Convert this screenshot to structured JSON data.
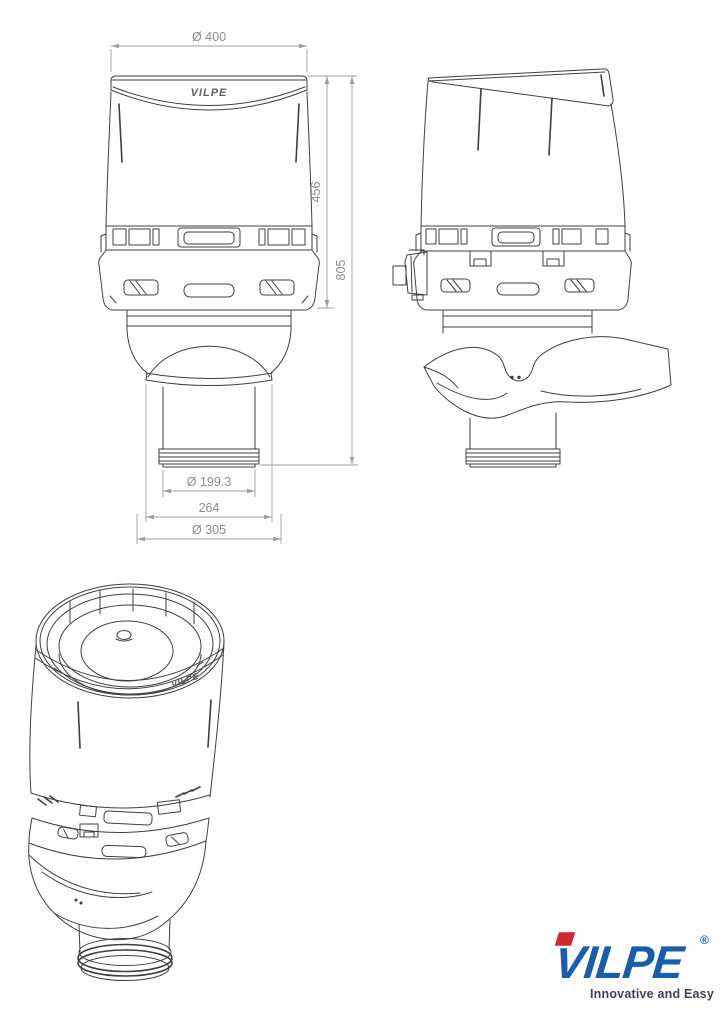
{
  "page": {
    "background": "#ffffff"
  },
  "drawing": {
    "front_view": {
      "dimensions": {
        "top_diameter": "Ø 400",
        "cap_height": "456",
        "total_height": "805",
        "pipe_diameter": "Ø 199.3",
        "outlet_width": "264",
        "insulation_diameter": "Ø 305"
      },
      "embossed_logo": "VILPE"
    },
    "isometric_view": {
      "embossed_logo": "VILPE"
    }
  },
  "brand": {
    "logo_text": "VILPE",
    "registered_mark": "®",
    "tagline": "Innovative and Easy",
    "colors": {
      "logo_blue": "#1a5dab",
      "logo_red": "#d1272e",
      "tagline": "#3d4353"
    }
  },
  "style": {
    "line_color": "#3f3f3f",
    "dimension_color": "#9e9e9e",
    "dimension_text_color": "#8c8c8c"
  }
}
